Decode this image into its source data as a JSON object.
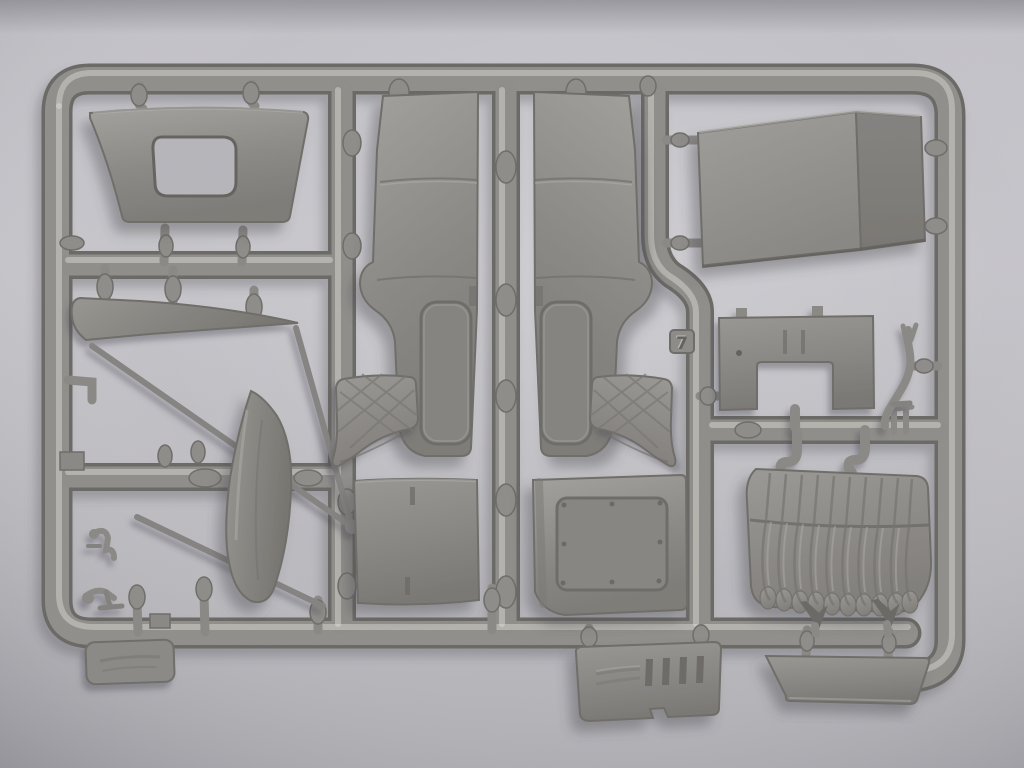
{
  "scene": {
    "type": "photograph",
    "subject": "Grey injection-molded plastic model-kit sprue (parts tree) photographed on a neutral light-grey background",
    "sprue_tag": "7"
  },
  "colors": {
    "background_light": "#c9c8cd",
    "background_dark": "#adacb1",
    "plastic_mid": "#8f8d89",
    "plastic_dark": "#6b6965",
    "plastic_highlight": "#b7b5b0",
    "shadow": "#4a4950"
  },
  "parts": [
    {
      "id": "cab-rear-panel",
      "label": "Cab rear panel with window cutout"
    },
    {
      "id": "roof-panel",
      "label": "Curved cab roof panel"
    },
    {
      "id": "cab-side-panel-left",
      "label": "Cab side panel, left"
    },
    {
      "id": "cab-side-panel-right",
      "label": "Cab side panel, right (mirror)"
    },
    {
      "id": "windshield-frame",
      "label": "Windshield frame blade with thin braces"
    },
    {
      "id": "front-fender",
      "label": "Curved pointed fender"
    },
    {
      "id": "seat-cushion-left",
      "label": "Small quilted cushion, left"
    },
    {
      "id": "seat-cushion-right",
      "label": "Small quilted cushion, right"
    },
    {
      "id": "door-inner-panel",
      "label": "Door panel with slits"
    },
    {
      "id": "riveted-plate",
      "label": "Panel with recessed riveted plate"
    },
    {
      "id": "firewall-panel",
      "label": "Firewall panel with U-cutout and slits"
    },
    {
      "id": "exhaust-pipe",
      "label": "Thin S-curved pipe"
    },
    {
      "id": "bench-seat",
      "label": "Pleated tufted bench seat"
    },
    {
      "id": "hook-gates",
      "label": "Curved hook gates above bench seat"
    },
    {
      "id": "louvered-plate",
      "label": "Plate with louver slots and embossed text"
    },
    {
      "id": "visor-panel",
      "label": "Trapezoid visor panel"
    },
    {
      "id": "small-levers",
      "label": "Small lever / pedal parts"
    },
    {
      "id": "label-tab",
      "label": "Molded label tab on lower frame"
    },
    {
      "id": "part-number-tag",
      "label": "Embossed sprue number tag"
    }
  ]
}
